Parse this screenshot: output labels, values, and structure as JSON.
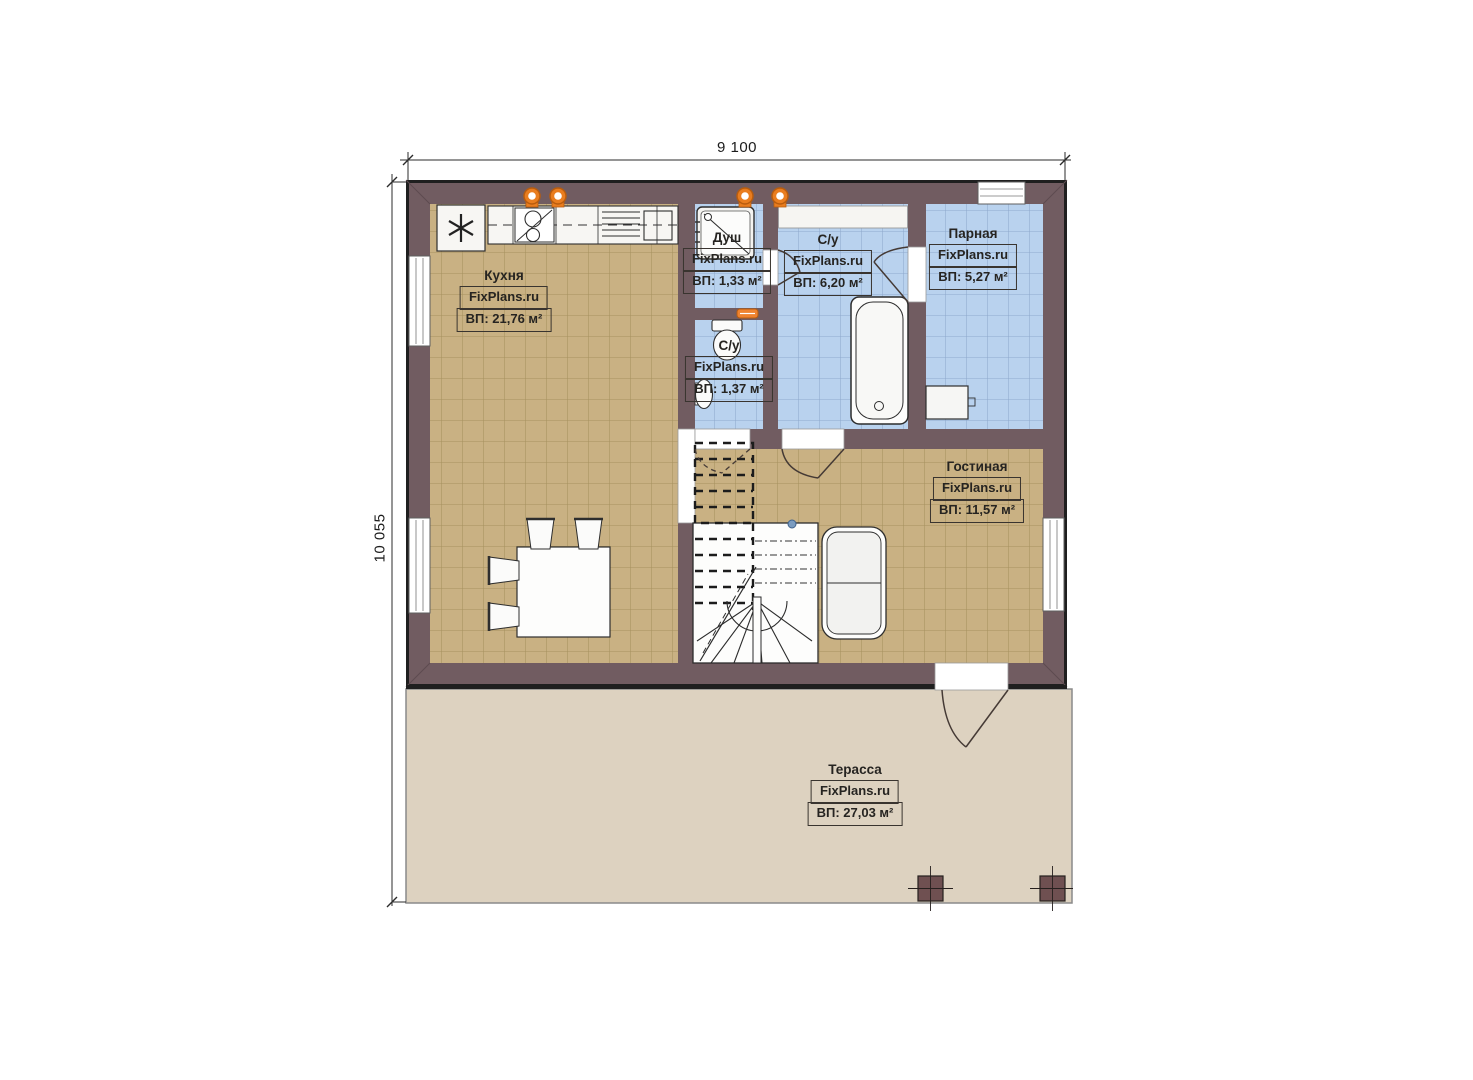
{
  "plan": {
    "dimensions": {
      "width": "9 100",
      "height": "10 055"
    },
    "watermark": "FixPlans.ru",
    "rooms": [
      {
        "key": "kitchen",
        "name": "Кухня",
        "area": "ВП: 21,76 м²"
      },
      {
        "key": "shower",
        "name": "Душ",
        "area": "ВП: 1,33 м²"
      },
      {
        "key": "bathroom",
        "name": "С/у",
        "area": "ВП: 6,20 м²"
      },
      {
        "key": "steam-room",
        "name": "Парная",
        "area": "ВП: 5,27 м²"
      },
      {
        "key": "wc",
        "name": "С/у",
        "area": "ВП: 1,37 м²"
      },
      {
        "key": "living-room",
        "name": "Гостиная",
        "area": "ВП: 11,57 м²"
      },
      {
        "key": "terrace",
        "name": "Терасса",
        "area": "ВП: 27,03 м²"
      }
    ],
    "colors": {
      "wall": "#715c61",
      "outline": "#1f1f1f",
      "floor_tile": "#c9b183",
      "floor_tile_line": "#a6915f",
      "wet_tile": "#b9d2ee",
      "wet_tile_line": "#8fa9cd",
      "terrace": "#ddd2c0",
      "accent_orange": "#e97d1f"
    }
  }
}
